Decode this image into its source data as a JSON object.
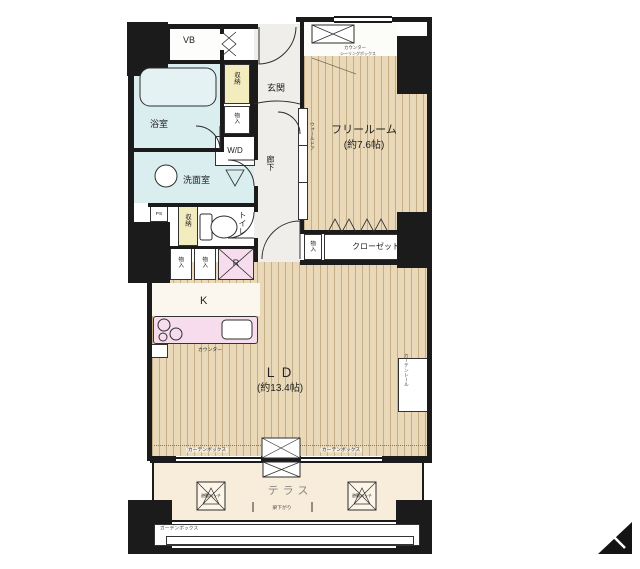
{
  "rooms": {
    "vb": "VB",
    "bath": "浴室",
    "washroom": "洗面室",
    "entrance": "玄関",
    "hallway": "廊下",
    "toilet": "トイレ",
    "free_room": "フリールーム",
    "free_room_size": "(約7.6帖)",
    "closet": "クローゼット",
    "kitchen": "K",
    "living_dining": "ＬＤ",
    "living_dining_size": "(約13.4帖)",
    "terrace": "テラス"
  },
  "fixtures": {
    "storage": "収納",
    "cabinet": "物入",
    "refrigerator": "R",
    "washer_dryer": "W/D",
    "pipe_space": "PS",
    "kitchen_counter": "カウンター",
    "counter_box_line1": "カウンター",
    "counter_box_line2": "シーリングボックス",
    "curtain_box": "カーテンボックス",
    "garden_box": "ガーデンボックス",
    "evacuation_hatch": "避難ハッチ",
    "beam_note": "梁下がり",
    "wall_door": "ウォールドア",
    "curtain_rail": "カーテンレール"
  },
  "colors": {
    "wall": "#1b1b1b",
    "wood_floor": "#ead9b8",
    "wet_area": "#daedef",
    "storage_yellow": "#f2ecbf",
    "accent_pink": "#f6dcec",
    "terrace": "#f8ecda",
    "hall": "#efeeea"
  }
}
